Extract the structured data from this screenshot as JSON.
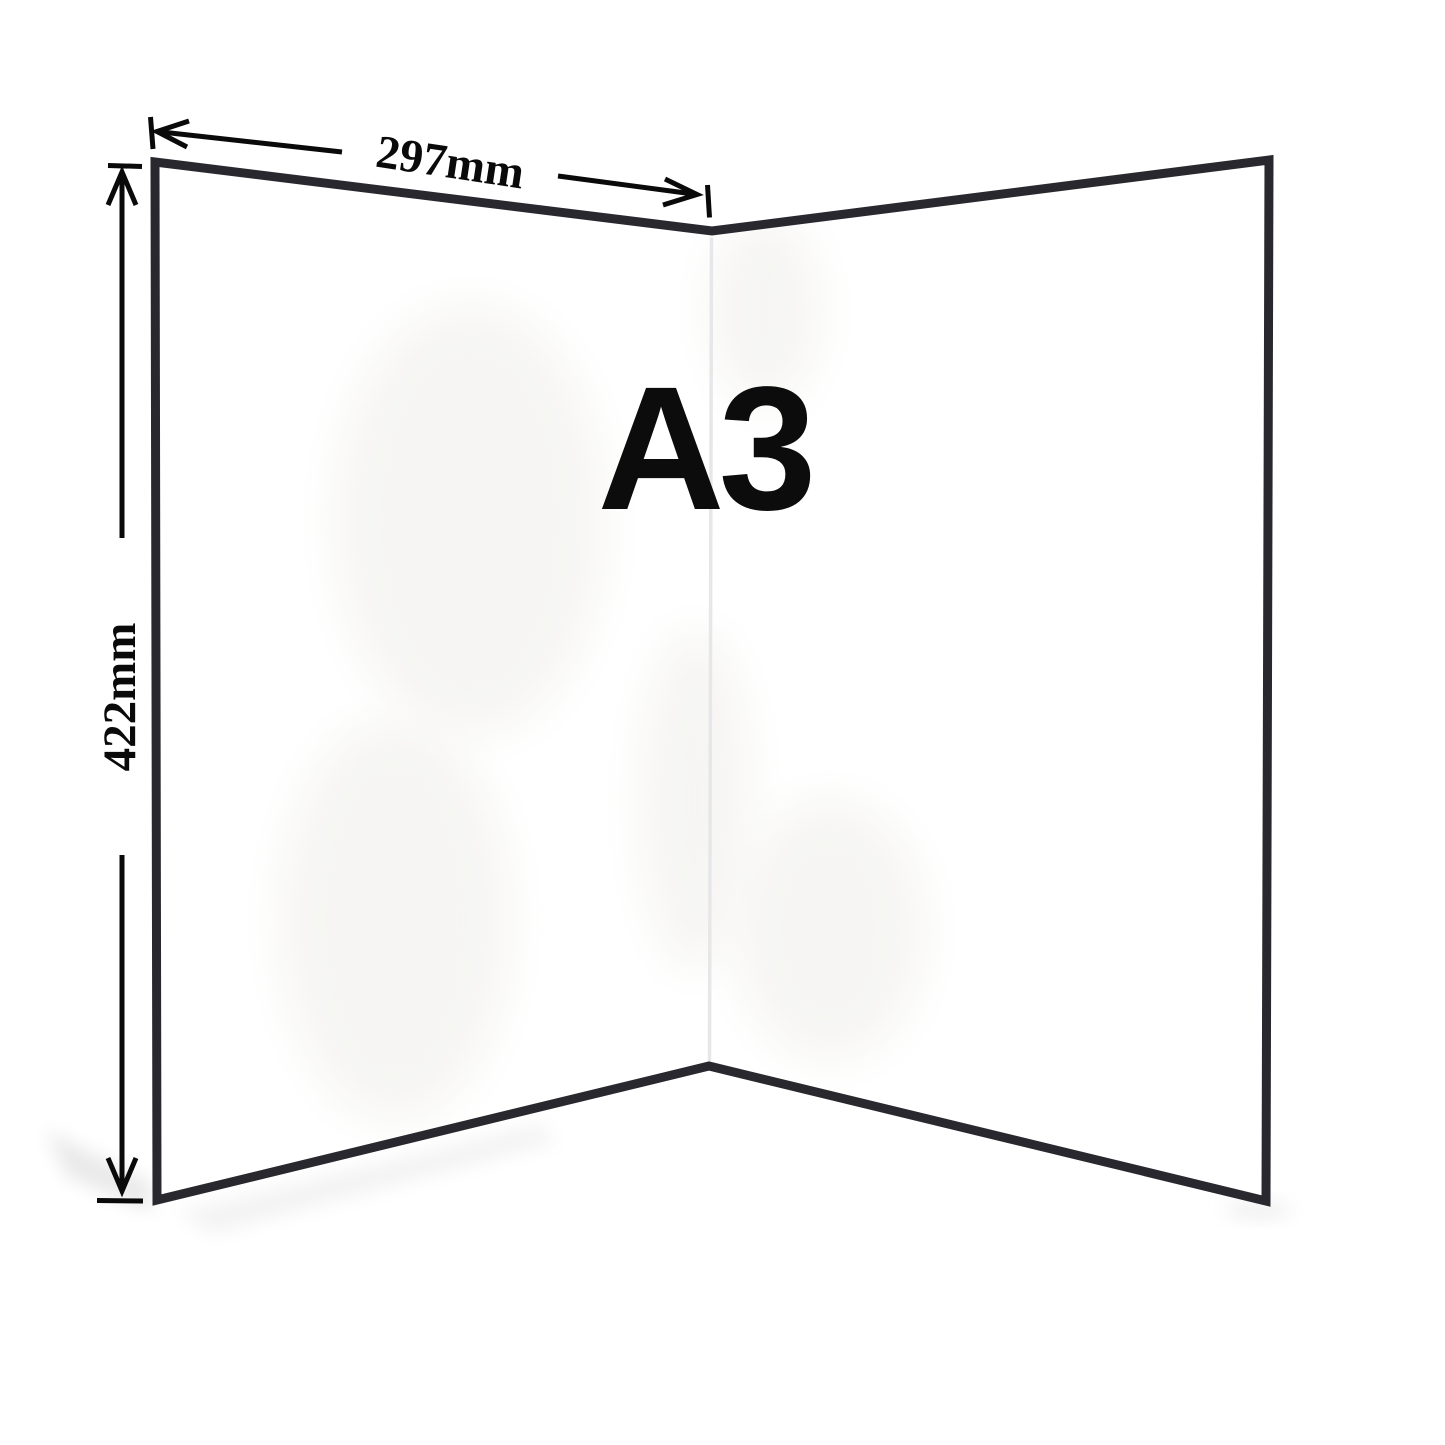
{
  "board": {
    "size_label": "A3",
    "width_dimension": {
      "label": "297mm"
    },
    "height_dimension": {
      "label": "422mm"
    }
  },
  "colors": {
    "background": "#ffffff",
    "panel_fill": "#ffffff",
    "board_border": "#28282e",
    "fold_line": "#e7e7e9",
    "annotation": "#0a0a0a",
    "shadow": "#e9e9e9",
    "glare": "#f6f5f3"
  }
}
